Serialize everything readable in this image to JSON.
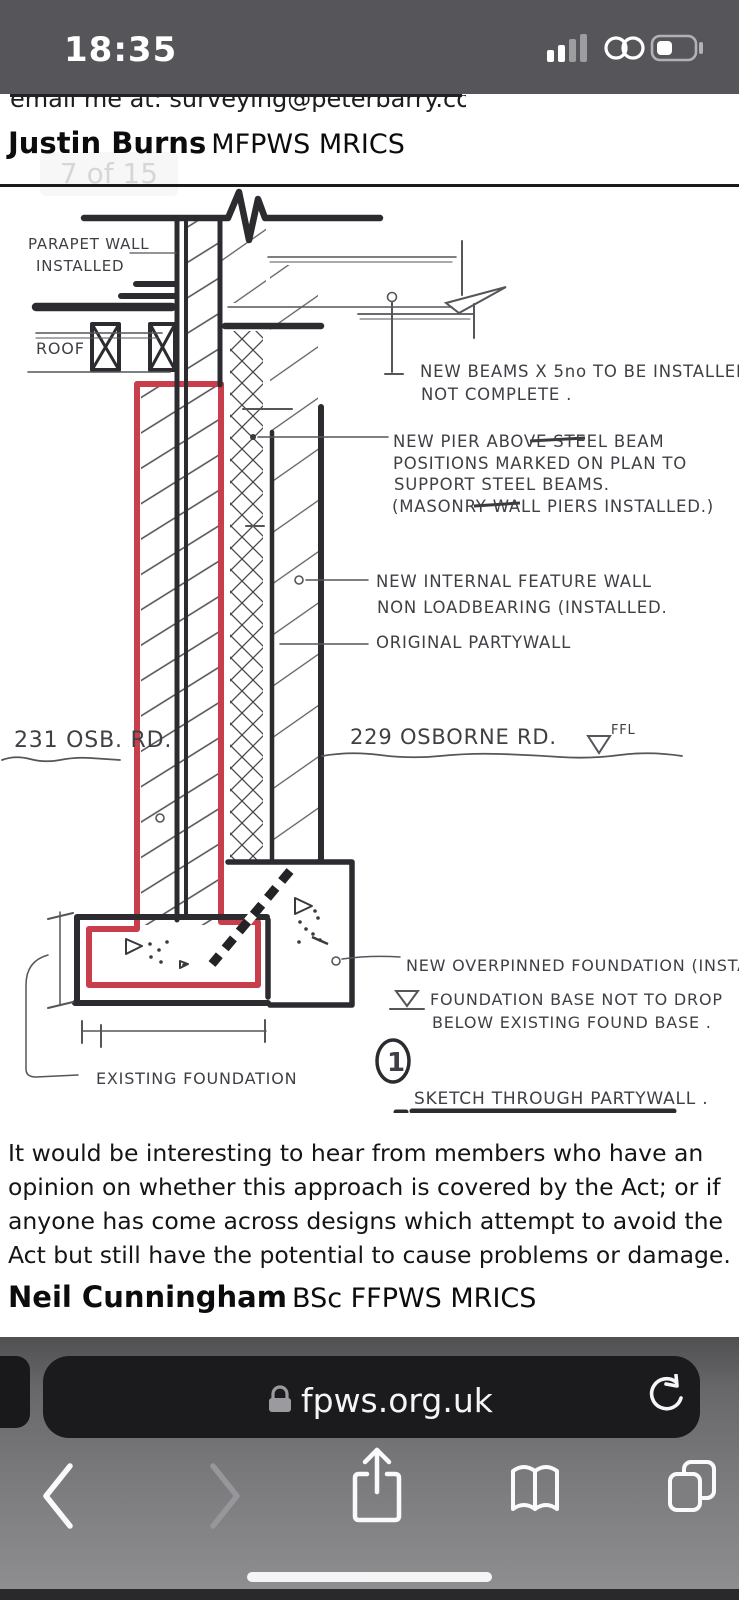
{
  "status_bar": {
    "time": "18:35",
    "icons": {
      "signal": "cellular-signal-icon",
      "link": "link-icon",
      "battery": "battery-icon"
    }
  },
  "document": {
    "email_line": "email me at: surveying@peterbarry.co.uk",
    "author_top": {
      "name": "Justin Burns",
      "credentials": "MFPWS MRICS"
    },
    "page_indicator": "7 of 15",
    "paragraph": "It would be interesting to hear from members who have an opinion on whether this approach is covered by the Act; or if anyone has come across designs which attempt to avoid the Act but still have the potential to cause problems or damage.",
    "author_bottom": {
      "name": "Neil Cunningham",
      "credentials": "BSc FFPWS MRICS"
    }
  },
  "sketch": {
    "ink_color": "#2c2c30",
    "red_color": "#c83e4b",
    "labels": {
      "parapet_l1": "PARAPET WALL",
      "parapet_l2": "INSTALLED",
      "roof": "ROOF",
      "beams_l1": "NEW BEAMS X 5no TO BE INSTALLED",
      "beams_l2": "NOT COMPLETE .",
      "pier_l1": "NEW PIER ABOVE STEEL BEAM",
      "pier_l2": "POSITIONS MARKED ON PLAN TO",
      "pier_l3": "SUPPORT STEEL BEAMS.",
      "pier_l4": "(MASONRY WALL PIERS INSTALLED.)",
      "feature_l1": "NEW INTERNAL FEATURE WALL",
      "feature_l2": "NON LOADBEARING (INSTALLED.",
      "original_wall": "ORIGINAL PARTYWALL",
      "addr_left": "231 OSB. RD.",
      "addr_right": "229 OSBORNE RD.",
      "ffl": "FFL",
      "overpin": "NEW OVERPINNED FOUNDATION (INSTALLED)",
      "base_l1": "FOUNDATION BASE NOT TO DROP",
      "base_l2": "BELOW EXISTING FOUND BASE .",
      "fig_no": "1",
      "caption": "SKETCH THROUGH PARTYWALL .",
      "existing": "EXISTING FOUNDATION"
    }
  },
  "browser": {
    "url": "fpws.org.uk",
    "icons": {
      "lock": "lock-icon",
      "reload": "reload-icon",
      "back": "back-icon",
      "forward": "forward-icon",
      "share": "share-icon",
      "bookmarks": "bookmarks-icon",
      "tabs": "tabs-icon",
      "home": "home-indicator"
    }
  }
}
